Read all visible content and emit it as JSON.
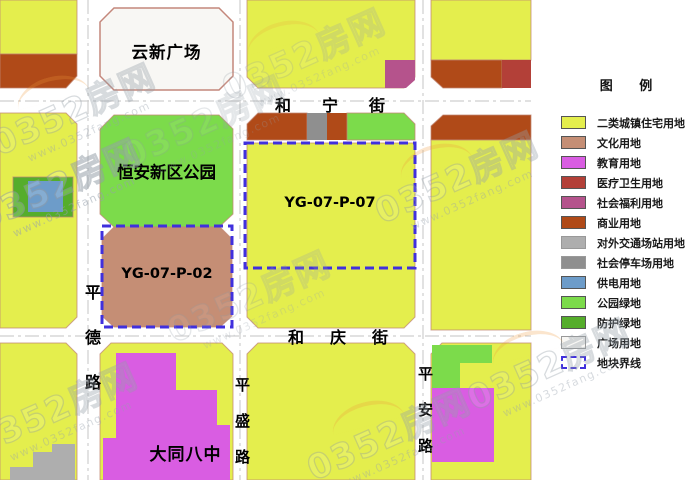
{
  "palette": {
    "residential": "#e4ee4d",
    "culture": "#c58e75",
    "education": "#d95de2",
    "medical": "#b34038",
    "welfare": "#b5538c",
    "commercial": "#b04a18",
    "transport_station": "#aeaeae",
    "parking": "#8f8f8f",
    "power": "#6d9cc9",
    "park_green": "#7cdb4b",
    "protective_green": "#55ad2b",
    "plaza": "#f8f7f4",
    "boundary": "#4030dd"
  },
  "legend": {
    "title": "图 例",
    "items": [
      {
        "label": "二类城镇住宅用地"
      },
      {
        "label": "文化用地"
      },
      {
        "label": "教育用地"
      },
      {
        "label": "医疗卫生用地"
      },
      {
        "label": "社会福利用地"
      },
      {
        "label": "商业用地"
      },
      {
        "label": "对外交通场站用地"
      },
      {
        "label": "社会停车场用地"
      },
      {
        "label": "供电用地"
      },
      {
        "label": "公园绿地"
      },
      {
        "label": "防护绿地"
      },
      {
        "label": "广场用地"
      },
      {
        "label": "地块界线"
      }
    ]
  },
  "map": {
    "blocks": {
      "yunxin_plaza": "云新广场",
      "hengan_park": "恒安新区公园",
      "plot_p02": "YG-07-P-02",
      "plot_p07": "YG-07-P-07",
      "datong_no8_school": "大同八中"
    },
    "streets": {
      "hening": "和宁街",
      "heqing": "和庆街",
      "pingde": "平德路",
      "pingsheng": "平盛路",
      "pingan": "平安路"
    }
  },
  "watermark": {
    "brand": "0352房网",
    "url": "www.0352fang.com"
  }
}
